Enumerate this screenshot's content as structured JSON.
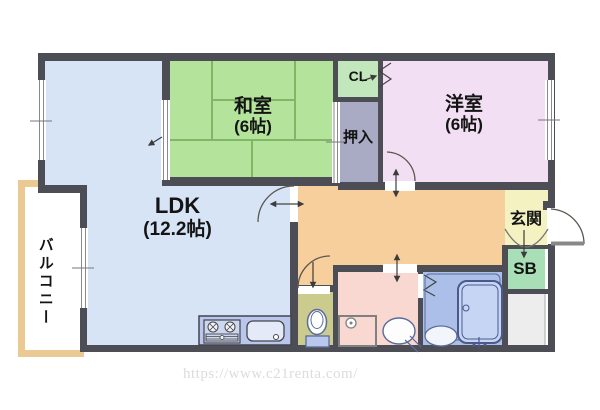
{
  "labels": {
    "washitsu": "和室",
    "washitsu_size": "(6帖)",
    "yoshitsu": "洋室",
    "yoshitsu_size": "(6帖)",
    "ldk": "LDK",
    "ldk_size": "(12.2帖)",
    "balcony": "バルコニー",
    "closet": "CL",
    "oshiire": "押入",
    "genkan": "玄関",
    "shoebox": "SB"
  },
  "watermark": "https://www.c21renta.com/",
  "colors": {
    "wall": "#4d4d55",
    "ldk": "#d6e4f6",
    "washitsu": "#b4e49c",
    "tatami_line": "#82b665",
    "closet": "#c3e7bd",
    "oshiire": "#a9aac4",
    "yoshitsu": "#f3dff3",
    "hall": "#f6cf9c",
    "genkan": "#f5f2c2",
    "shoebox": "#a9dfb6",
    "storage": "#ededed",
    "washroom": "#f8d8d0",
    "toilet": "#cbcb8e",
    "bathroom": "#abbfe8",
    "bathtub": "#c6d5f4",
    "kitchen": "#b9c7ec",
    "balcony_frame": "#eac992",
    "watermark_text": "#dcdcdc"
  }
}
